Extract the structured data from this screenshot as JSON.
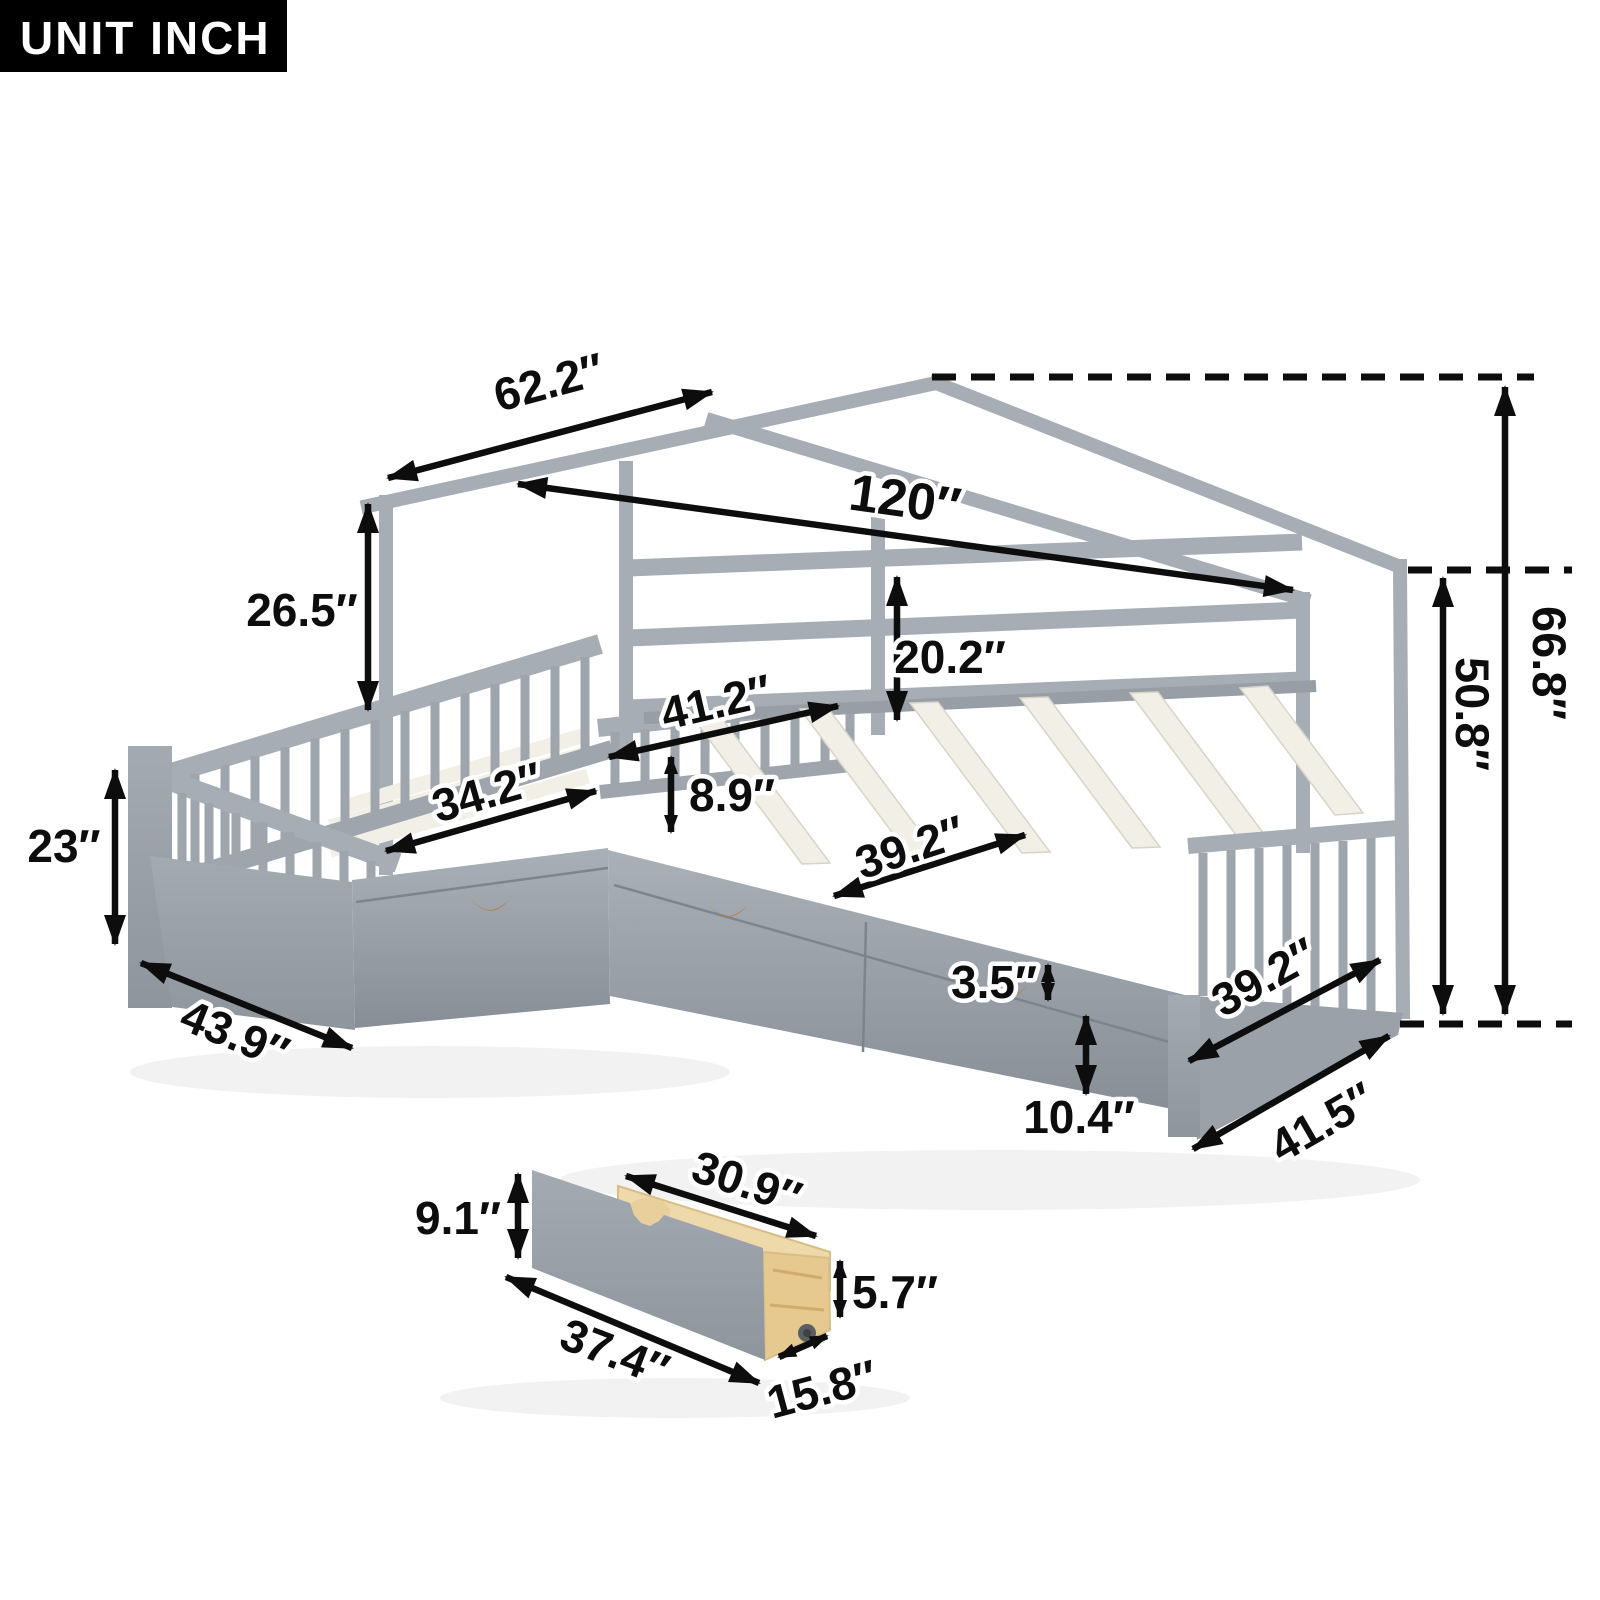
{
  "unit_badge": "UNIT INCH",
  "colors": {
    "frame_gray": "#a7adb5",
    "bed_gray": "#9ea5ad",
    "bed_gray_dark": "#8b929a",
    "slat_cream": "#f2efe7",
    "wood_tan": "#eed9ab",
    "handle_tan": "#bc7b3e",
    "dimension_black": "#0d0d0d",
    "badge_bg": "#000000",
    "badge_text": "#ffffff"
  },
  "dims": {
    "bed": [
      {
        "id": "roof-slope-length",
        "label": "62.2″"
      },
      {
        "id": "total-length",
        "label": "120″"
      },
      {
        "id": "roof-to-rail-height",
        "label": "26.5″"
      },
      {
        "id": "foot-rail-height",
        "label": "23″"
      },
      {
        "id": "left-bed-outer-width",
        "label": "43.9″"
      },
      {
        "id": "left-bed-slat-width",
        "label": "34.2″"
      },
      {
        "id": "junction-width",
        "label": "41.2″"
      },
      {
        "id": "guardrail-height",
        "label": "8.9″"
      },
      {
        "id": "headboard-rail-height",
        "label": "20.2″"
      },
      {
        "id": "right-bed-slat-width",
        "label": "39.2″"
      },
      {
        "id": "side-rail-thickness",
        "label": "3.5″"
      },
      {
        "id": "under-bed-clearance",
        "label": "10.4″"
      },
      {
        "id": "footboard-width",
        "label": "39.2″"
      },
      {
        "id": "right-bed-outer-width",
        "label": "41.5″"
      },
      {
        "id": "overall-height",
        "label": "66.8″"
      },
      {
        "id": "wall-post-height",
        "label": "50.8″"
      }
    ],
    "drawer": [
      {
        "id": "drawer-front-height",
        "label": "9.1″"
      },
      {
        "id": "drawer-box-length",
        "label": "30.9″"
      },
      {
        "id": "drawer-box-height",
        "label": "5.7″"
      },
      {
        "id": "drawer-front-length",
        "label": "37.4″"
      },
      {
        "id": "drawer-box-depth",
        "label": "15.8″"
      }
    ]
  }
}
